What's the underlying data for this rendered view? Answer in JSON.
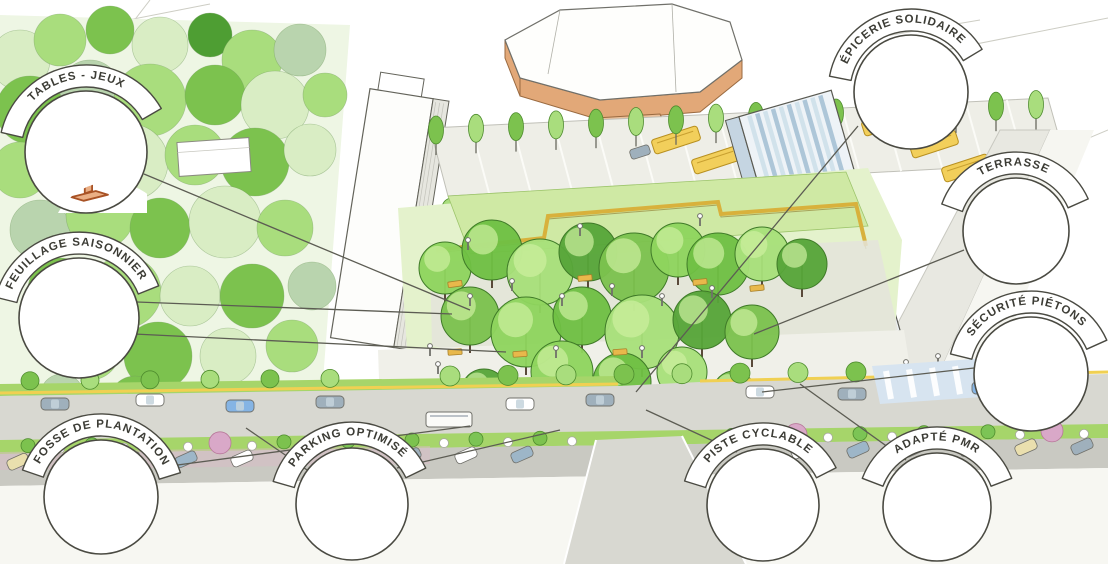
{
  "figure": {
    "description": "Hand-drawn perspective sketch of an urban redevelopment concept: a tree-filled public park and redesigned boulevard between residential towers, annotated with nine circular callouts.",
    "language": "fr"
  },
  "palette": {
    "ink": "#4a4a42",
    "green_pale": "#d9edc4",
    "green_light": "#a9dd7d",
    "green_mid": "#7cc24e",
    "green_dark": "#4e9e33",
    "green_sage": "#b9d4ae",
    "green_verge": "#a6d56a",
    "meadow": "#cfe9a4",
    "yellow_bench": "#e8b84b",
    "yellow_bus": "#f2cf5b",
    "yellow_line": "#f0d052",
    "road_gray": "#d8d8d1",
    "parking_gray": "#c9c9c2",
    "car_gray": "#9fb0bc",
    "car_blue": "#85b4e4",
    "car_beige": "#eadfae",
    "pink_tree": "#d9a8c8",
    "bike_lane_blue": "#85b8e8",
    "terrace_floor": "#f4c9b6",
    "stadium_wall": "#e2a878",
    "umbrella_orange": "#e0703a",
    "tower_stripe_blue": "#a9c3d6"
  },
  "annotations": [
    {
      "id": "tables-jeux",
      "label": "TABLES - JEUX",
      "icon": "game-table-icon"
    },
    {
      "id": "feuillage-saisonnier",
      "label": "FEUILLAGE SAISONNIER",
      "icon": "seasonal-foliage-icon"
    },
    {
      "id": "fosse-de-plantation",
      "label": "FOSSE DE PLANTATION",
      "icon": "planting-pit-icon"
    },
    {
      "id": "parking-optimise",
      "label": "PARKING OPTIMISÉ",
      "icon": "parked-car-icon"
    },
    {
      "id": "piste-cyclable",
      "label": "PISTE CYCLABLE",
      "icon": "bike-lane-icon"
    },
    {
      "id": "adapte-pmr",
      "label": "ADAPTÉ PMR",
      "icon": "wheelchair-user-icon"
    },
    {
      "id": "securite-pietons",
      "label": "SÉCURITÉ PIÉTONS",
      "icon": "pedestrians-icon"
    },
    {
      "id": "terrasse",
      "label": "TERRASSE",
      "icon": "terrace-icon"
    },
    {
      "id": "epicerie-solidaire",
      "label": "ÉPICERIE SOLIDAIRE",
      "icon": "vegetable-crate-icon"
    }
  ]
}
